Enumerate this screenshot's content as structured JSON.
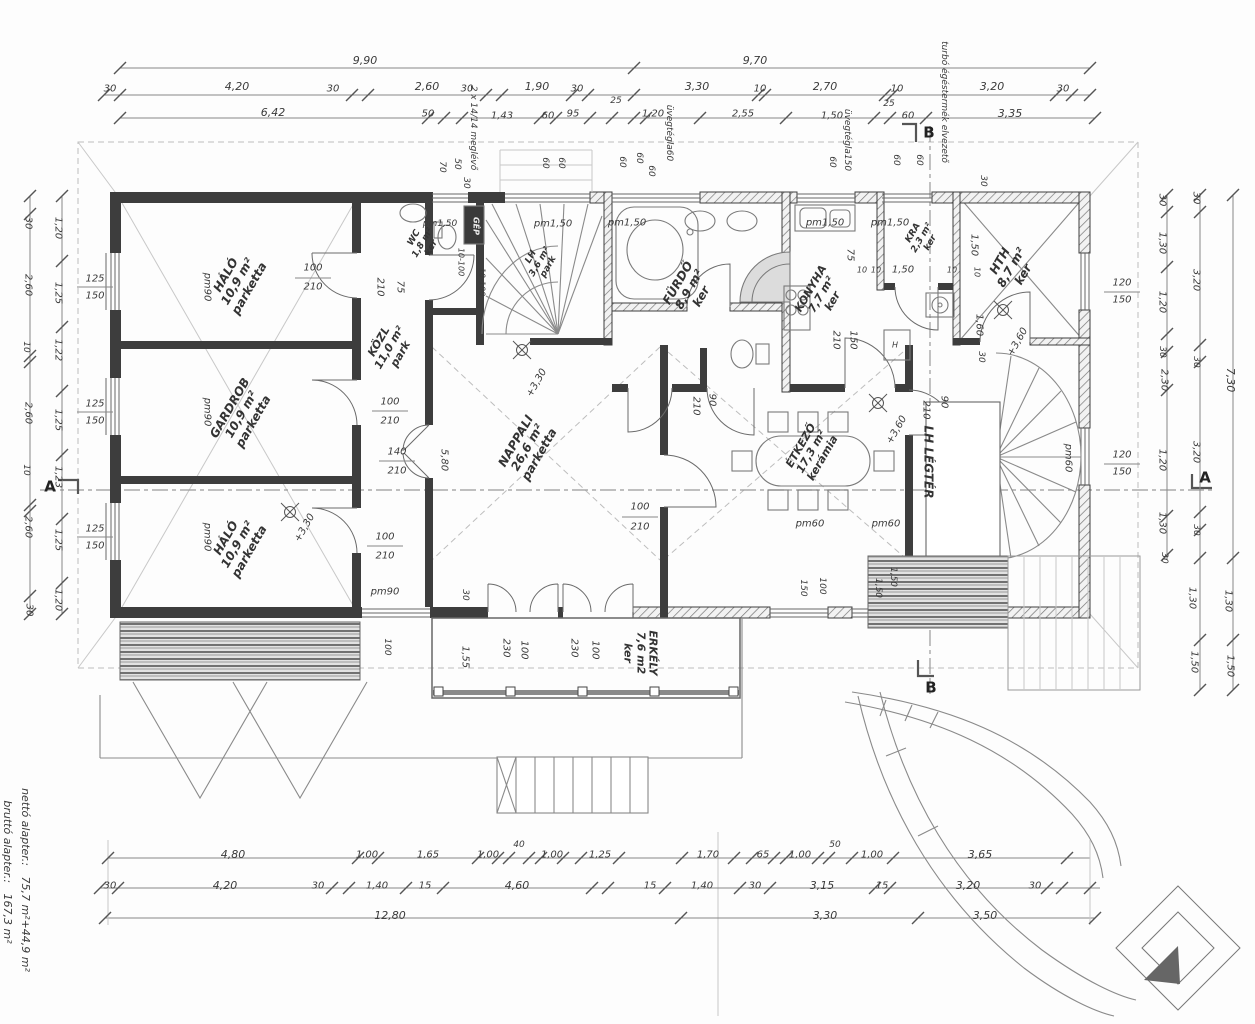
{
  "plan": {
    "type": "floor-plan",
    "language": "Hungarian",
    "area_summary": {
      "netto_label": "nettó alapter.:",
      "netto_value": "75,7 m²+44,9 m²",
      "brutto_label": "bruttó alapter.:",
      "brutto_value": "167,3 m²"
    }
  },
  "rooms": [
    {
      "name": "HÁLÓ",
      "area": "10,9 m²",
      "floor": "parketta",
      "x": 238,
      "y": 282,
      "r": -60,
      "s": 12
    },
    {
      "name": "GARDROB",
      "area": "10,9 m²",
      "floor": "parketta",
      "x": 242,
      "y": 415,
      "r": -60,
      "s": 12
    },
    {
      "name": "HÁLÓ",
      "area": "10,9 m²",
      "floor": "parketta",
      "x": 238,
      "y": 545,
      "r": -60,
      "s": 12
    },
    {
      "name": "KÖZL",
      "area": "11,0 m²",
      "floor": "park",
      "x": 390,
      "y": 348,
      "r": -60,
      "s": 11
    },
    {
      "name": "WC",
      "area": "1,8 m²",
      "floor": "ker",
      "x": 423,
      "y": 243,
      "r": -60,
      "s": 9
    },
    {
      "name": "LH",
      "area": "3,6 m²",
      "floor": "park",
      "x": 540,
      "y": 262,
      "r": -60,
      "s": 9
    },
    {
      "name": "NAPPALI",
      "area": "26,6 m²",
      "floor": "parketta",
      "x": 528,
      "y": 448,
      "r": -60,
      "s": 12
    },
    {
      "name": "FÜRDŐ",
      "area": "8,9 m²",
      "floor": "ker",
      "x": 690,
      "y": 290,
      "r": -60,
      "s": 12
    },
    {
      "name": "KONYHA",
      "area": "7,7 m²",
      "floor": "ker",
      "x": 822,
      "y": 295,
      "r": -60,
      "s": 11
    },
    {
      "name": "KRA",
      "area": "2,3 m²",
      "floor": "ker",
      "x": 922,
      "y": 238,
      "r": -60,
      "s": 9
    },
    {
      "name": "HTH",
      "area": "8,7 m²",
      "floor": "ker",
      "x": 1012,
      "y": 268,
      "r": -60,
      "s": 12
    },
    {
      "name": "ÉTKEZŐ",
      "area": "17,3 m²",
      "floor": "kerámia",
      "x": 812,
      "y": 452,
      "r": -60,
      "s": 11
    },
    {
      "name": "LH LÉGTÉR",
      "area": "",
      "floor": "",
      "x": 928,
      "y": 462,
      "r": 90,
      "s": 12
    },
    {
      "name": "ERKÉLY",
      "area": "7,6 m2",
      "floor": "ker",
      "x": 640,
      "y": 653,
      "r": 90,
      "s": 11
    }
  ],
  "dims": [
    {
      "t": "9,90",
      "x": 365,
      "y": 61,
      "s": 11
    },
    {
      "t": "9,70",
      "x": 755,
      "y": 61,
      "s": 11
    },
    {
      "t": "30",
      "x": 110,
      "y": 89
    },
    {
      "t": "4,20",
      "x": 237,
      "y": 87,
      "s": 11
    },
    {
      "t": "30",
      "x": 333,
      "y": 89
    },
    {
      "t": "2,60",
      "x": 427,
      "y": 87,
      "s": 11
    },
    {
      "t": "30",
      "x": 467,
      "y": 89
    },
    {
      "t": "1,90",
      "x": 537,
      "y": 87,
      "s": 11
    },
    {
      "t": "30",
      "x": 577,
      "y": 89
    },
    {
      "t": "3,30",
      "x": 697,
      "y": 87,
      "s": 11
    },
    {
      "t": "10",
      "x": 760,
      "y": 89
    },
    {
      "t": "2,70",
      "x": 825,
      "y": 87,
      "s": 11
    },
    {
      "t": "10",
      "x": 897,
      "y": 89
    },
    {
      "t": "3,20",
      "x": 992,
      "y": 87,
      "s": 11
    },
    {
      "t": "30",
      "x": 1063,
      "y": 89
    },
    {
      "t": "25",
      "x": 616,
      "y": 101,
      "s": 9
    },
    {
      "t": "25",
      "x": 889,
      "y": 104,
      "s": 9
    },
    {
      "t": "6,42",
      "x": 273,
      "y": 113,
      "s": 11
    },
    {
      "t": "50",
      "x": 428,
      "y": 114
    },
    {
      "t": "1,43",
      "x": 502,
      "y": 116
    },
    {
      "t": "60",
      "x": 548,
      "y": 116
    },
    {
      "t": "95",
      "x": 573,
      "y": 114
    },
    {
      "t": "1,20",
      "x": 653,
      "y": 114
    },
    {
      "t": "2,55",
      "x": 743,
      "y": 114
    },
    {
      "t": "1,50",
      "x": 832,
      "y": 116
    },
    {
      "t": "60",
      "x": 908,
      "y": 116
    },
    {
      "t": "3,35",
      "x": 1010,
      "y": 114,
      "s": 11
    },
    {
      "t": "70",
      "x": 442,
      "y": 167,
      "r": 90,
      "s": 9
    },
    {
      "t": "50",
      "x": 457,
      "y": 164,
      "r": 90,
      "s": 9
    },
    {
      "t": "30",
      "x": 466,
      "y": 183,
      "r": 90,
      "s": 9
    },
    {
      "t": "60",
      "x": 545,
      "y": 163,
      "r": 90,
      "s": 9
    },
    {
      "t": "60",
      "x": 561,
      "y": 163,
      "r": 90,
      "s": 9
    },
    {
      "t": "60",
      "x": 622,
      "y": 162,
      "r": 90,
      "s": 9
    },
    {
      "t": "60",
      "x": 639,
      "y": 158,
      "r": 90,
      "s": 9
    },
    {
      "t": "60",
      "x": 651,
      "y": 171,
      "r": 90,
      "s": 9
    },
    {
      "t": "60",
      "x": 832,
      "y": 162,
      "r": 90,
      "s": 9
    },
    {
      "t": "60",
      "x": 896,
      "y": 160,
      "r": 90,
      "s": 9
    },
    {
      "t": "60",
      "x": 919,
      "y": 160,
      "r": 90,
      "s": 9
    },
    {
      "t": "30",
      "x": 983,
      "y": 181,
      "r": 90,
      "s": 9
    },
    {
      "t": "30",
      "x": 28,
      "y": 223,
      "r": 90
    },
    {
      "t": "2,60",
      "x": 28,
      "y": 285,
      "r": 90
    },
    {
      "t": "10",
      "x": 26,
      "y": 347,
      "r": 90,
      "s": 9
    },
    {
      "t": "2,60",
      "x": 28,
      "y": 413,
      "r": 90
    },
    {
      "t": "10",
      "x": 26,
      "y": 470,
      "r": 90,
      "s": 9
    },
    {
      "t": "2,60",
      "x": 28,
      "y": 527,
      "r": 90
    },
    {
      "t": "30",
      "x": 29,
      "y": 610,
      "r": 90
    },
    {
      "t": "1,20",
      "x": 58,
      "y": 228,
      "r": 90
    },
    {
      "t": "1,25",
      "x": 58,
      "y": 293,
      "r": 90
    },
    {
      "t": "1,22",
      "x": 58,
      "y": 350,
      "r": 90
    },
    {
      "t": "1,25",
      "x": 58,
      "y": 420,
      "r": 90
    },
    {
      "t": "1,23",
      "x": 58,
      "y": 477,
      "r": 90
    },
    {
      "t": "1,25",
      "x": 58,
      "y": 540,
      "r": 90
    },
    {
      "t": "1,20",
      "x": 58,
      "y": 600,
      "r": 90
    },
    {
      "t": "125",
      "x": 95,
      "y": 279
    },
    {
      "t": "150",
      "x": 95,
      "y": 296
    },
    {
      "t": "125",
      "x": 95,
      "y": 404
    },
    {
      "t": "150",
      "x": 95,
      "y": 421
    },
    {
      "t": "125",
      "x": 95,
      "y": 529
    },
    {
      "t": "150",
      "x": 95,
      "y": 546
    },
    {
      "t": "30",
      "x": 1162,
      "y": 200,
      "r": 90
    },
    {
      "t": "1,30",
      "x": 1162,
      "y": 243,
      "r": 90
    },
    {
      "t": "1,20",
      "x": 1162,
      "y": 302,
      "r": 90
    },
    {
      "t": "30",
      "x": 1162,
      "y": 352,
      "r": 90,
      "s": 9
    },
    {
      "t": "2,30",
      "x": 1164,
      "y": 380,
      "r": 90
    },
    {
      "t": "1,20",
      "x": 1162,
      "y": 460,
      "r": 90
    },
    {
      "t": "1,30",
      "x": 1162,
      "y": 523,
      "r": 90
    },
    {
      "t": "30",
      "x": 1164,
      "y": 558,
      "r": 90,
      "s": 9
    },
    {
      "t": "30",
      "x": 1196,
      "y": 198,
      "r": 90
    },
    {
      "t": "3,20",
      "x": 1196,
      "y": 280,
      "r": 90
    },
    {
      "t": "30",
      "x": 1196,
      "y": 362,
      "r": 90,
      "s": 9
    },
    {
      "t": "3,20",
      "x": 1196,
      "y": 452,
      "r": 90
    },
    {
      "t": "30",
      "x": 1196,
      "y": 530,
      "r": 90,
      "s": 9
    },
    {
      "t": "1,30",
      "x": 1192,
      "y": 598,
      "r": 90
    },
    {
      "t": "1,50",
      "x": 1194,
      "y": 662,
      "r": 90
    },
    {
      "t": "7,30",
      "x": 1230,
      "y": 380,
      "r": 90,
      "s": 11
    },
    {
      "t": "1,30",
      "x": 1228,
      "y": 601,
      "r": 90
    },
    {
      "t": "1,50",
      "x": 1230,
      "y": 666,
      "r": 90
    },
    {
      "t": "120",
      "x": 1122,
      "y": 283
    },
    {
      "t": "150",
      "x": 1122,
      "y": 300
    },
    {
      "t": "120",
      "x": 1122,
      "y": 455
    },
    {
      "t": "150",
      "x": 1122,
      "y": 472
    },
    {
      "t": "4,80",
      "x": 233,
      "y": 855,
      "s": 11
    },
    {
      "t": "1,00",
      "x": 367,
      "y": 855
    },
    {
      "t": "1,65",
      "x": 428,
      "y": 855
    },
    {
      "t": "1,00",
      "x": 488,
      "y": 855
    },
    {
      "t": "40",
      "x": 519,
      "y": 845,
      "s": 9
    },
    {
      "t": "1,00",
      "x": 552,
      "y": 855
    },
    {
      "t": "1,25",
      "x": 600,
      "y": 855
    },
    {
      "t": "1,70",
      "x": 708,
      "y": 855
    },
    {
      "t": "65",
      "x": 763,
      "y": 855
    },
    {
      "t": "1,00",
      "x": 800,
      "y": 855
    },
    {
      "t": "50",
      "x": 835,
      "y": 845,
      "s": 9
    },
    {
      "t": "1,00",
      "x": 872,
      "y": 855
    },
    {
      "t": "3,65",
      "x": 980,
      "y": 855,
      "s": 11
    },
    {
      "t": "30",
      "x": 110,
      "y": 886
    },
    {
      "t": "4,20",
      "x": 225,
      "y": 886,
      "s": 11
    },
    {
      "t": "30",
      "x": 318,
      "y": 886
    },
    {
      "t": "1,40",
      "x": 377,
      "y": 886
    },
    {
      "t": "15",
      "x": 425,
      "y": 886
    },
    {
      "t": "4,60",
      "x": 517,
      "y": 886,
      "s": 11
    },
    {
      "t": "15",
      "x": 650,
      "y": 886
    },
    {
      "t": "1,40",
      "x": 702,
      "y": 886
    },
    {
      "t": "30",
      "x": 755,
      "y": 886
    },
    {
      "t": "3,15",
      "x": 822,
      "y": 886,
      "s": 11
    },
    {
      "t": "15",
      "x": 882,
      "y": 886
    },
    {
      "t": "3,20",
      "x": 968,
      "y": 886,
      "s": 11
    },
    {
      "t": "30",
      "x": 1035,
      "y": 886
    },
    {
      "t": "12,80",
      "x": 390,
      "y": 916,
      "s": 11
    },
    {
      "t": "3,30",
      "x": 825,
      "y": 916,
      "s": 11
    },
    {
      "t": "3,50",
      "x": 985,
      "y": 916,
      "s": 11
    },
    {
      "t": "100",
      "x": 313,
      "y": 268
    },
    {
      "t": "210",
      "x": 313,
      "y": 287
    },
    {
      "t": "100",
      "x": 390,
      "y": 402
    },
    {
      "t": "210",
      "x": 390,
      "y": 421
    },
    {
      "t": "100",
      "x": 385,
      "y": 537
    },
    {
      "t": "210",
      "x": 385,
      "y": 556
    },
    {
      "t": "140",
      "x": 397,
      "y": 452
    },
    {
      "t": "210",
      "x": 397,
      "y": 471
    },
    {
      "t": "100",
      "x": 640,
      "y": 507
    },
    {
      "t": "210",
      "x": 640,
      "y": 527
    },
    {
      "t": "210",
      "x": 696,
      "y": 406,
      "r": 90
    },
    {
      "t": "90",
      "x": 712,
      "y": 400,
      "r": 90
    },
    {
      "t": "210",
      "x": 926,
      "y": 410,
      "r": 90
    },
    {
      "t": "90",
      "x": 944,
      "y": 402,
      "r": 90
    },
    {
      "t": "210",
      "x": 380,
      "y": 287,
      "r": 90
    },
    {
      "t": "75",
      "x": 400,
      "y": 287,
      "r": 90
    },
    {
      "t": "75",
      "x": 850,
      "y": 255,
      "r": 90
    },
    {
      "t": "10",
      "x": 862,
      "y": 271,
      "s": 8
    },
    {
      "t": "10",
      "x": 876,
      "y": 271,
      "s": 8
    },
    {
      "t": "1,50",
      "x": 903,
      "y": 270
    },
    {
      "t": "10",
      "x": 952,
      "y": 271,
      "s": 8
    },
    {
      "t": "150",
      "x": 853,
      "y": 340,
      "r": 90
    },
    {
      "t": "210",
      "x": 836,
      "y": 340,
      "r": 90
    },
    {
      "t": "1,50",
      "x": 974,
      "y": 245,
      "r": 90
    },
    {
      "t": "10",
      "x": 976,
      "y": 272,
      "r": 90,
      "s": 8
    },
    {
      "t": "1,60",
      "x": 979,
      "y": 325,
      "r": 90
    },
    {
      "t": "30",
      "x": 981,
      "y": 357,
      "r": 90,
      "s": 9
    },
    {
      "t": "5,80",
      "x": 444,
      "y": 460,
      "r": 90
    },
    {
      "t": "1,55",
      "x": 465,
      "y": 657,
      "r": 90
    },
    {
      "t": "230",
      "x": 506,
      "y": 648,
      "r": 90
    },
    {
      "t": "100",
      "x": 524,
      "y": 650,
      "r": 90
    },
    {
      "t": "230",
      "x": 574,
      "y": 648,
      "r": 90
    },
    {
      "t": "100",
      "x": 595,
      "y": 650,
      "r": 90
    },
    {
      "t": "150",
      "x": 803,
      "y": 588,
      "r": 90,
      "s": 9
    },
    {
      "t": "100",
      "x": 822,
      "y": 586,
      "r": 90,
      "s": 9
    },
    {
      "t": "1,50",
      "x": 878,
      "y": 588,
      "r": 90,
      "s": 9
    },
    {
      "t": "1,50",
      "x": 893,
      "y": 577,
      "r": 90,
      "s": 9
    },
    {
      "t": "30",
      "x": 465,
      "y": 595,
      "r": 90,
      "s": 9
    },
    {
      "t": "100",
      "x": 387,
      "y": 647,
      "r": 90,
      "s": 9
    },
    {
      "t": "H",
      "x": 895,
      "y": 346,
      "s": 8
    }
  ],
  "annotations": [
    {
      "t": "pm90",
      "x": 207,
      "y": 287,
      "r": 90,
      "n": "window-tag"
    },
    {
      "t": "pm90",
      "x": 207,
      "y": 412,
      "r": 90,
      "n": "window-tag"
    },
    {
      "t": "pm90",
      "x": 207,
      "y": 537,
      "r": 90,
      "n": "window-tag"
    },
    {
      "t": "pm90",
      "x": 385,
      "y": 592,
      "n": "window-tag"
    },
    {
      "t": "pm1,50",
      "x": 440,
      "y": 224,
      "s": 9,
      "n": "window-tag"
    },
    {
      "t": "pm1,50",
      "x": 553,
      "y": 224,
      "n": "window-tag"
    },
    {
      "t": "pm1,50",
      "x": 627,
      "y": 223,
      "n": "window-tag"
    },
    {
      "t": "pm1,50",
      "x": 825,
      "y": 223,
      "n": "window-tag"
    },
    {
      "t": "pm1,50",
      "x": 890,
      "y": 223,
      "n": "window-tag"
    },
    {
      "t": "pm60",
      "x": 810,
      "y": 524,
      "n": "window-tag"
    },
    {
      "t": "pm60",
      "x": 886,
      "y": 524,
      "n": "window-tag"
    },
    {
      "t": "pm60",
      "x": 1068,
      "y": 458,
      "r": 90,
      "n": "window-tag"
    },
    {
      "t": "+3,30",
      "x": 537,
      "y": 383,
      "r": -60,
      "n": "level-mark"
    },
    {
      "t": "+3,30",
      "x": 305,
      "y": 528,
      "r": -60,
      "n": "level-mark"
    },
    {
      "t": "+3,60",
      "x": 897,
      "y": 430,
      "r": -60,
      "n": "level-mark"
    },
    {
      "t": "+3,60",
      "x": 1018,
      "y": 342,
      "r": -60,
      "n": "level-mark"
    },
    {
      "t": "GÉP",
      "x": 475,
      "y": 226,
      "r": 90,
      "s": 8,
      "c": "inv",
      "n": "equipment-label"
    },
    {
      "t": "10-100",
      "x": 460,
      "y": 262,
      "r": 90,
      "s": 8,
      "n": "radiator-tag"
    },
    {
      "t": "10-100",
      "x": 481,
      "y": 282,
      "r": 90,
      "s": 8,
      "n": "radiator-tag"
    },
    {
      "t": "2 x 14/14 meglévő",
      "x": 473,
      "y": 128,
      "r": 90,
      "s": 9,
      "n": "note"
    },
    {
      "t": "üvegtégla60",
      "x": 669,
      "y": 133,
      "r": 90,
      "s": 9,
      "n": "note"
    },
    {
      "t": "üvegtégla150",
      "x": 847,
      "y": 140,
      "r": 90,
      "s": 9,
      "n": "note"
    },
    {
      "t": "turbó égéstermék elvezető",
      "x": 944,
      "y": 102,
      "r": 90,
      "s": 9,
      "n": "note"
    },
    {
      "t": "A",
      "x": 50,
      "y": 487,
      "s": 15,
      "c": "mark",
      "n": "section-marker"
    },
    {
      "t": "A",
      "x": 1205,
      "y": 478,
      "s": 15,
      "c": "mark",
      "n": "section-marker"
    },
    {
      "t": "B",
      "x": 929,
      "y": 133,
      "s": 15,
      "c": "mark",
      "n": "section-marker"
    },
    {
      "t": "B",
      "x": 931,
      "y": 688,
      "s": 15,
      "c": "mark",
      "n": "section-marker"
    },
    {
      "t": "nettó alapter.:   75,7 m²+44,9 m²",
      "x": 25,
      "y": 880,
      "r": 90,
      "s": 11,
      "n": "area-summary"
    },
    {
      "t": "bruttó alapter.:   167,3 m²",
      "x": 7,
      "y": 872,
      "r": 90,
      "s": 11,
      "n": "area-summary"
    }
  ]
}
